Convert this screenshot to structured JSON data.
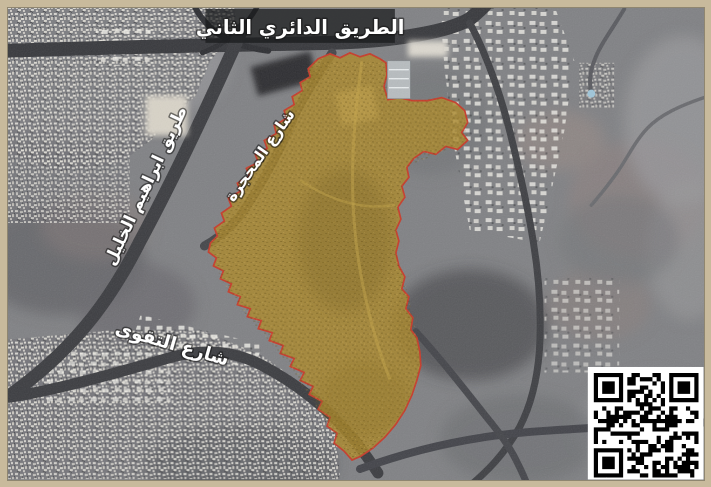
{
  "figure": {
    "type": "satellite-map",
    "frame_color": "#c8ba9c",
    "labels": {
      "ring_road": "الطريق الدائري الثاني",
      "khalil_road": "طريق ابراهيم الخليل",
      "mahjara_street": "شارع المحجرة",
      "taqwa_street": "شارع التقوى"
    },
    "highlight": {
      "fill_color": "#ab8828",
      "border_color": "#c63b2a"
    },
    "qr_code": {
      "present": true,
      "foreground": "#000000",
      "background": "#ffffff"
    }
  }
}
